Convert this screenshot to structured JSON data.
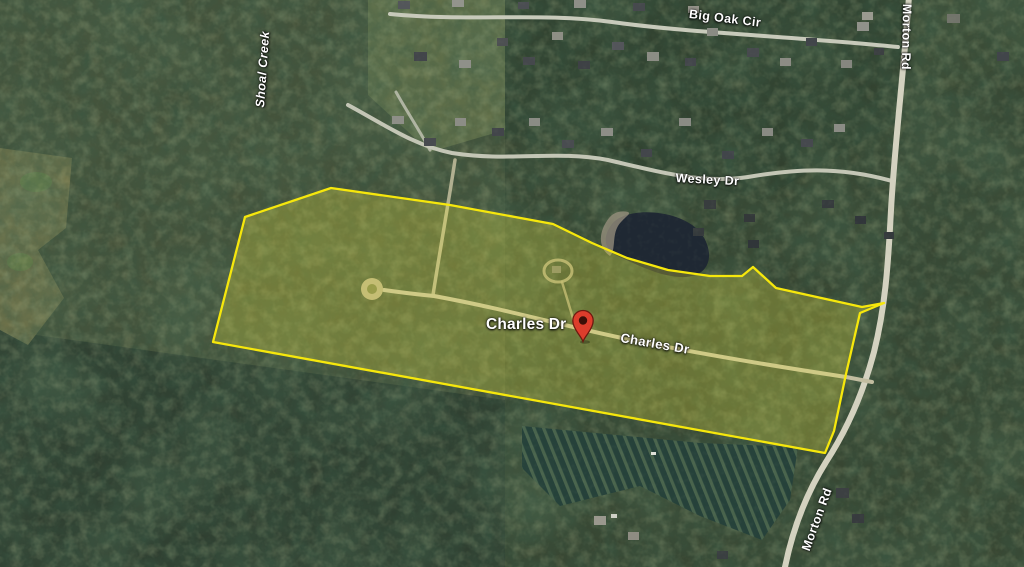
{
  "view": {
    "type": "satellite-aerial-map"
  },
  "labels": {
    "big_oak_cir": "Big Oak Cir",
    "morton_rd_top": "Morton Rd",
    "shoal_creek": "Shoal Creek",
    "wesley_dr": "Wesley Dr",
    "charles_dr_primary": "Charles Dr",
    "charles_dr_secondary": "Charles Dr",
    "morton_rd_bottom": "Morton Rd"
  },
  "marker": {
    "color": "#dd3d2c",
    "outline_color": "#6d1a10",
    "dot_color": "#3c0f08"
  },
  "parcel": {
    "outline_color": "#f6e70c",
    "fill_color": "#f9ee3c",
    "fill_opacity": "0.26"
  }
}
